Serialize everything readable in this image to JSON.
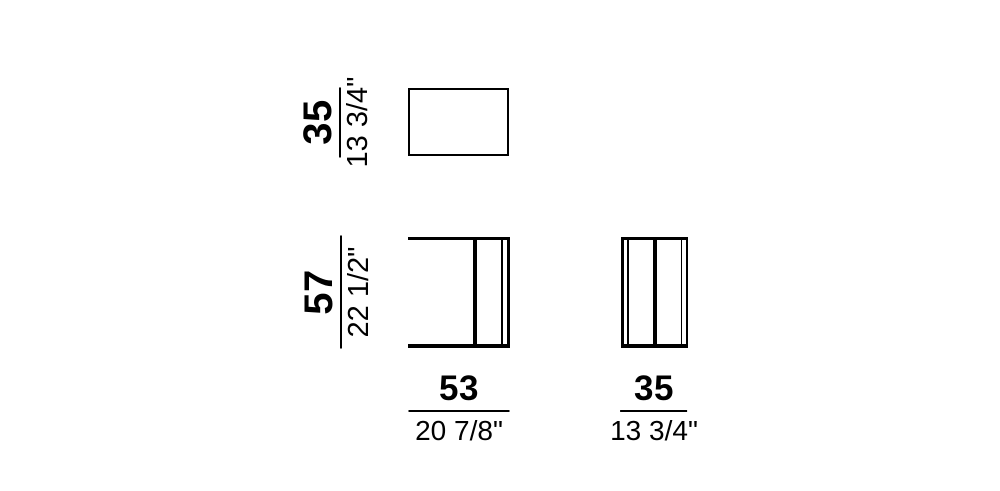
{
  "page": {
    "background": "#ffffff",
    "line_color": "#000000",
    "description": "Furniture dimension drawing with top view, front view and side view"
  },
  "dimensions": {
    "top_depth": {
      "cm": "35",
      "inch": "13 3/4\""
    },
    "height": {
      "cm": "57",
      "inch": "22 1/2\""
    },
    "width": {
      "cm": "53",
      "inch": "20 7/8\""
    },
    "bottom_depth": {
      "cm": "35",
      "inch": "13 3/4\""
    }
  }
}
